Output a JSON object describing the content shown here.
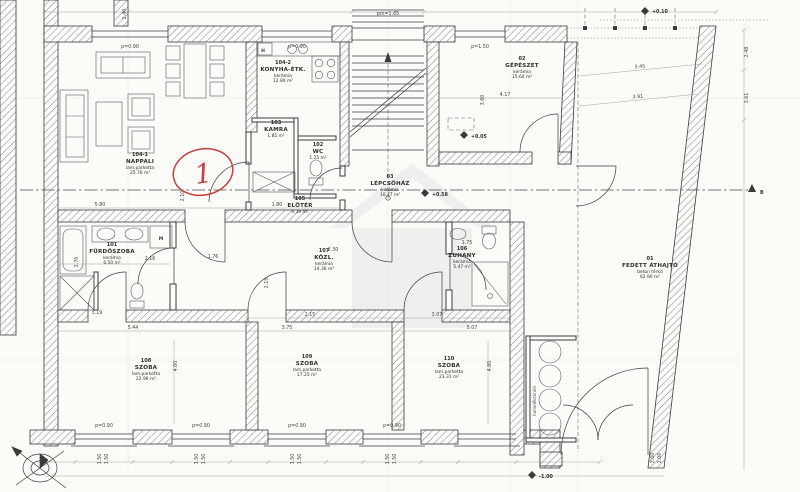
{
  "plan": {
    "rooms": {
      "nappali": {
        "number": "104-1",
        "name": "NAPPALI",
        "finish": "lam.parketta",
        "area": "25.76 m²"
      },
      "konyha": {
        "number": "104-2",
        "name": "KONYHA-ÉTK.",
        "finish": "kerámia",
        "area": "12.80 m²"
      },
      "kamra": {
        "number": "103",
        "name": "KAMRA",
        "finish": "kerámia",
        "area": "1.85 m²"
      },
      "wc": {
        "number": "102",
        "name": "WC",
        "finish": "kerámia",
        "area": "1.25 m²"
      },
      "eloter": {
        "number": "105",
        "name": "ELŐTÉR",
        "finish": "kerámia",
        "area": "4.39 m²"
      },
      "zuhany": {
        "number": "106",
        "name": "ZUHANY",
        "finish": "kerámia",
        "area": "5.47 m²"
      },
      "kozl": {
        "number": "107",
        "name": "KÖZL.",
        "finish": "kerámia",
        "area": "14.36 m²"
      },
      "furdoszoba": {
        "number": "101",
        "name": "FÜRDŐSZOBA",
        "finish": "kerámia",
        "area": "6.50 m²"
      },
      "szoba108": {
        "number": "108",
        "name": "SZOBA",
        "finish": "lam.parketta",
        "area": "22.96 m²"
      },
      "szoba109": {
        "number": "109",
        "name": "SZOBA",
        "finish": "lam.parketta",
        "area": "17.25 m²"
      },
      "szoba110": {
        "number": "110",
        "name": "SZOBA",
        "finish": "lam.parketta",
        "area": "23.31 m²"
      },
      "lepcsohaz": {
        "number": "03",
        "name": "LÉPCSŐHÁZ",
        "finish": "kerámia",
        "area": "10.77 m²"
      },
      "gepeszet": {
        "number": "02",
        "name": "GÉPÉSZET",
        "finish": "kerámia",
        "area": "15.60 m²"
      },
      "athajto": {
        "number": "01",
        "name": "FEDETT ÁTHAJTÓ",
        "finish": "beton térkő",
        "area": "62.90 m²"
      }
    },
    "levels": {
      "lepcsohaz": "+0.58",
      "gepeszet": "+0.05",
      "utca": "+0.10",
      "udvar": "-1.00"
    },
    "window_labels": {
      "parapet": "p=0.90",
      "parapet2": "p=1.50",
      "lintel": "pm=1.65",
      "size": "1.50"
    },
    "fixtures": {
      "washing_machine": "M",
      "fridge": "H"
    },
    "dims": [
      "5.80",
      "1.80",
      "2.30",
      "2.15",
      "2.15",
      "3.75",
      "3.07",
      "5.44",
      "3.19",
      "2.16",
      "2.70",
      "4.00",
      "4.60",
      "4.17",
      "3.60",
      "3.45",
      "3.91",
      "2.48",
      "3.61",
      "2.40",
      "1.75",
      "1.76",
      "5.07",
      "3.00",
      "2.00",
      "2.10"
    ],
    "annotation": {
      "mark": "1"
    },
    "section": {
      "label": "B"
    },
    "niche_label": "hulladéktároló"
  }
}
